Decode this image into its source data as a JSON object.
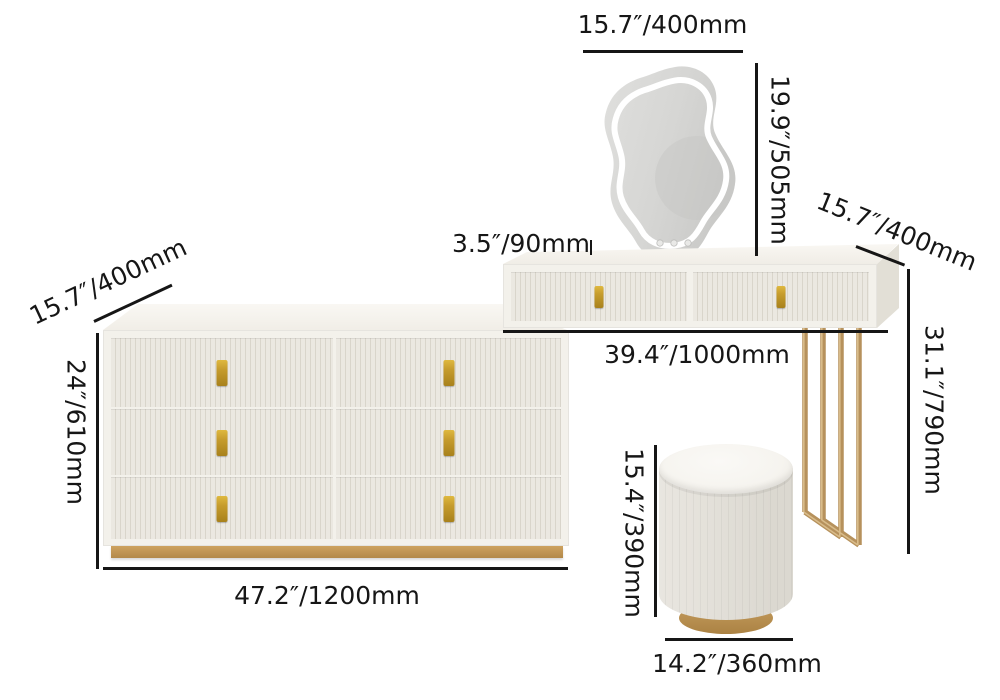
{
  "diagram": {
    "kind": "product-dimension-diagram",
    "name": "vanity-set-with-led-mirror-dresser-and-stool"
  },
  "labels": {
    "mirror_width": "15.7″/400mm",
    "mirror_height": "19.9″/505mm",
    "table_drawer_height": "3.5″/90mm",
    "table_depth": "15.7″/400mm",
    "table_height": "31.1″/790mm",
    "table_width": "39.4″/1000mm",
    "dresser_depth": "15.7″/400mm",
    "dresser_height": "24″/610mm",
    "dresser_width": "47.2″/1200mm",
    "stool_height": "15.4″/390mm",
    "stool_diameter": "14.2″/360mm"
  },
  "colors": {
    "background": "#ffffff",
    "line": "#161616",
    "cream": "#f3f1eb",
    "flute_light": "#ebe8e1",
    "flute_dark": "#d9d5cb",
    "side_shade": "#e2dfd6",
    "top_sheen": "#faf8f4",
    "handle_gold": "#c79d2e",
    "handle_gold_dark": "#a8811c",
    "leg_gold": "#b6915c",
    "leg_gold_light": "#d9bc8a",
    "plinth_gold": "#cda25f",
    "plinth_gold_dark": "#b3894a",
    "stool_body": "#ece9e2",
    "stool_top": "#f6f4ef",
    "stool_gold": "#c69e60"
  }
}
